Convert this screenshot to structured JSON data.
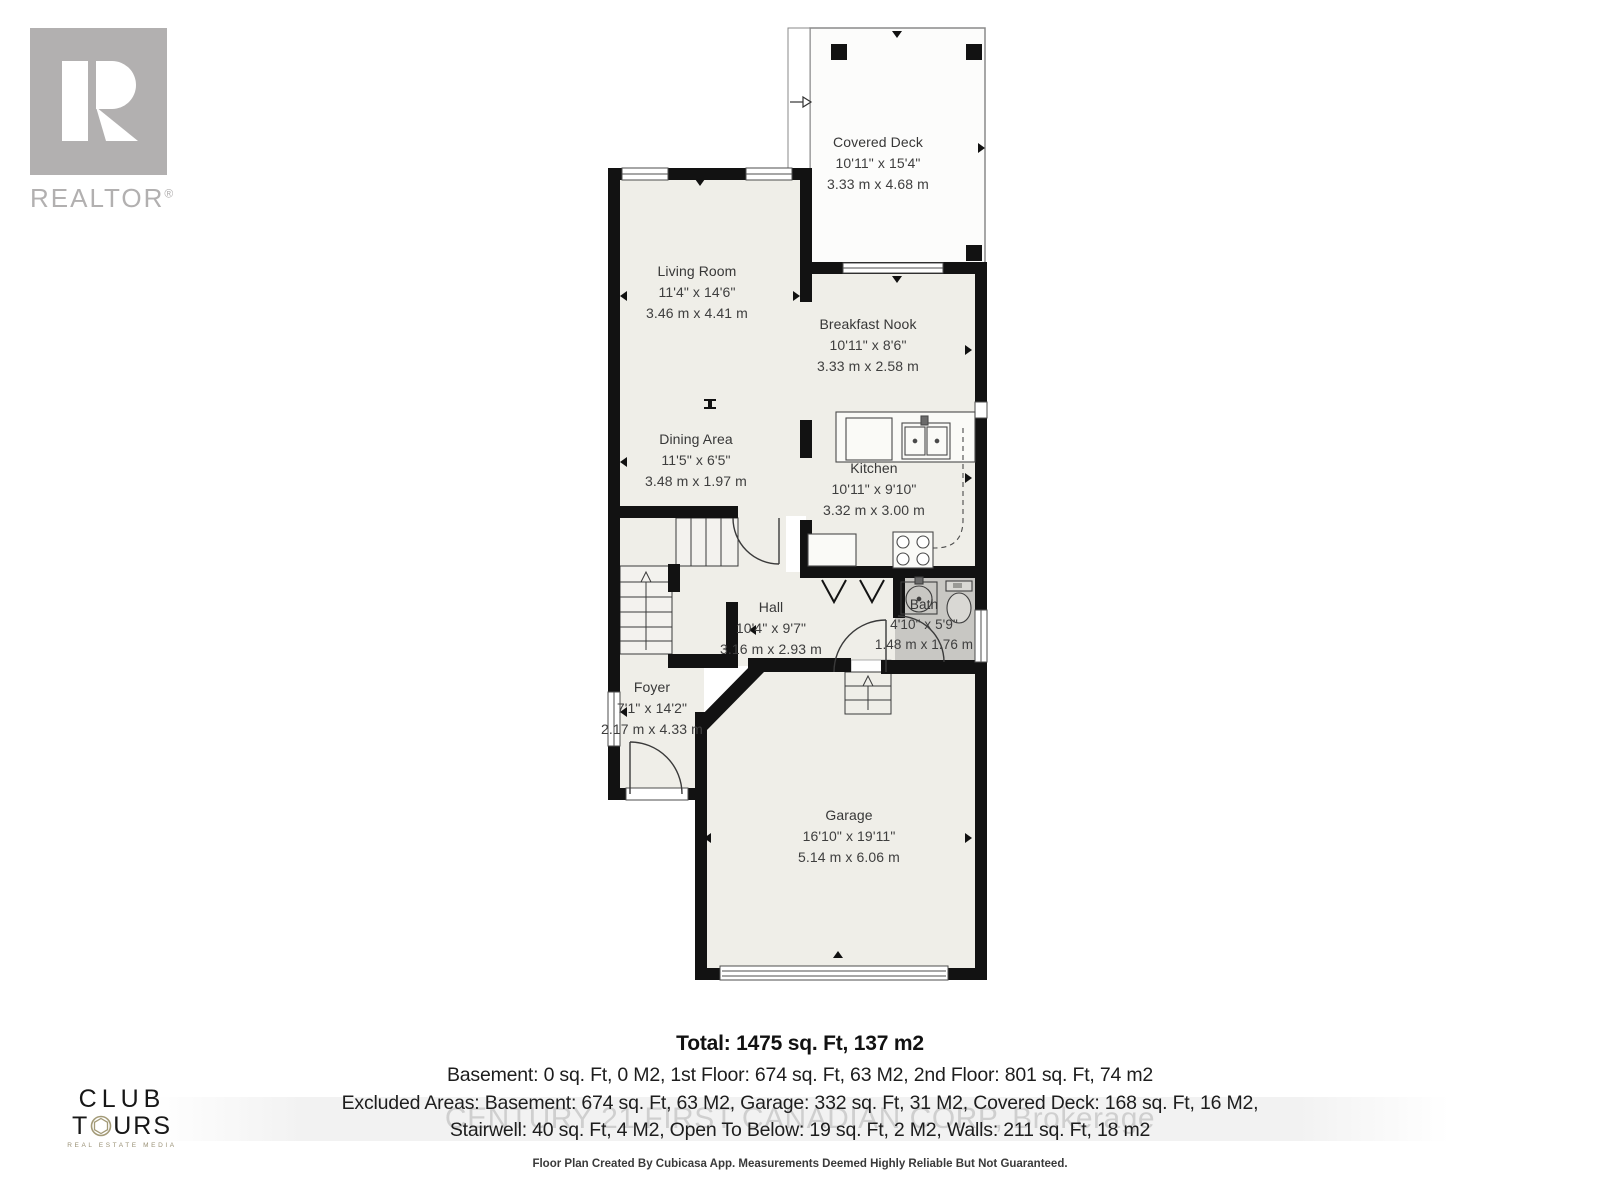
{
  "branding": {
    "realtor": {
      "word": "REALTOR",
      "reg": "®"
    },
    "club_tours": {
      "line1": "CLUB",
      "t_prefix": "T",
      "t_suffix": "URS",
      "tagline": "REAL ESTATE MEDIA"
    }
  },
  "floorplan": {
    "rooms": [
      {
        "id": "covered-deck",
        "name": "Covered Deck",
        "imperial": "10'11\" x 15'4\"",
        "metric": "3.33 m x 4.68 m"
      },
      {
        "id": "living-room",
        "name": "Living Room",
        "imperial": "11'4\" x 14'6\"",
        "metric": "3.46 m x 4.41 m"
      },
      {
        "id": "breakfast-nook",
        "name": "Breakfast Nook",
        "imperial": "10'11\" x 8'6\"",
        "metric": "3.33 m x 2.58 m"
      },
      {
        "id": "dining-area",
        "name": "Dining Area",
        "imperial": "11'5\" x 6'5\"",
        "metric": "3.48 m x 1.97 m"
      },
      {
        "id": "kitchen",
        "name": "Kitchen",
        "imperial": "10'11\" x 9'10\"",
        "metric": "3.32 m x 3.00 m"
      },
      {
        "id": "hall",
        "name": "Hall",
        "imperial": "10'4\" x 9'7\"",
        "metric": "3.16 m x 2.93 m"
      },
      {
        "id": "bath",
        "name": "Bath",
        "imperial": "4'10\" x 5'9\"",
        "metric": "1.48 m x 1.76 m"
      },
      {
        "id": "foyer",
        "name": "Foyer",
        "imperial": "7'1\" x 14'2\"",
        "metric": "2.17 m x 4.33 m"
      },
      {
        "id": "garage",
        "name": "Garage",
        "imperial": "16'10\" x 19'11\"",
        "metric": "5.14 m x 6.06 m"
      }
    ]
  },
  "summary": {
    "total": "Total: 1475 sq. Ft, 137 m2",
    "line1": "Basement: 0 sq. Ft, 0 M2, 1st Floor: 674 sq. Ft, 63 M2, 2nd Floor: 801 sq. Ft, 74 m2",
    "line2": "Excluded Areas: Basement: 674 sq. Ft, 63 M2, Garage: 332 sq. Ft, 31 M2, Covered Deck: 168 sq. Ft, 16 M2,",
    "line3": "Stairwell: 40 sq. Ft, 4 M2, Open To Below: 19 sq. Ft, 2 M2, Walls: 211 sq. Ft, 18 m2",
    "watermark": "CENTURY 21 FIRST CANADIAN CORP, Brokerage",
    "disclaimer": "Floor Plan Created By Cubicasa App. Measurements Deemed Highly Reliable But Not Guaranteed."
  },
  "colors": {
    "wall": "#121212",
    "room_fill": "#efeee8",
    "bath_fill": "#c8c7c3",
    "deck_fill": "#fcfcfb",
    "logo_gray": "#b2b0b0",
    "aperture_tan": "#a39a77"
  }
}
